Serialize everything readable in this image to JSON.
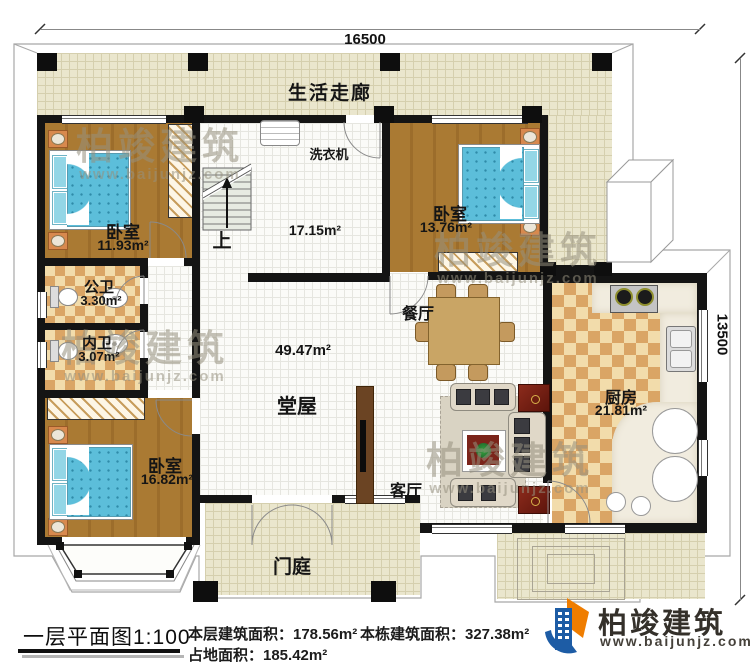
{
  "annotations": {
    "dim_top": "16500",
    "dim_right": "13500",
    "up": "上",
    "washer": "洗衣机"
  },
  "rooms": {
    "corridor": "生活走廊",
    "bedroom_tl": {
      "name": "卧室",
      "area": "11.93m²"
    },
    "bedroom_tr": {
      "name": "卧室",
      "area": "13.76m²"
    },
    "bedroom_bl": {
      "name": "卧室",
      "area": "16.82m²"
    },
    "public_bath": {
      "name": "公卫",
      "area": "3.30m²"
    },
    "ensuite_bath": {
      "name": "内卫",
      "area": "3.07m²"
    },
    "stair_hall": {
      "area": "17.15m²"
    },
    "hall": {
      "name": "堂屋",
      "area": "49.47m²"
    },
    "dining": {
      "name": "餐厅"
    },
    "living": {
      "name": "客厅"
    },
    "kitchen": {
      "name": "厨房",
      "area": "21.81m²"
    },
    "porch": {
      "name": "门庭"
    }
  },
  "footer": {
    "title": "一层平面图1:100",
    "stat1": "本层建筑面积：178.56m²",
    "stat2": "本栋建筑面积：327.38m²",
    "stat3": "占地面积：185.42m²"
  },
  "brand": {
    "name": "柏竣建筑",
    "url": "www.baijunjz.com"
  }
}
